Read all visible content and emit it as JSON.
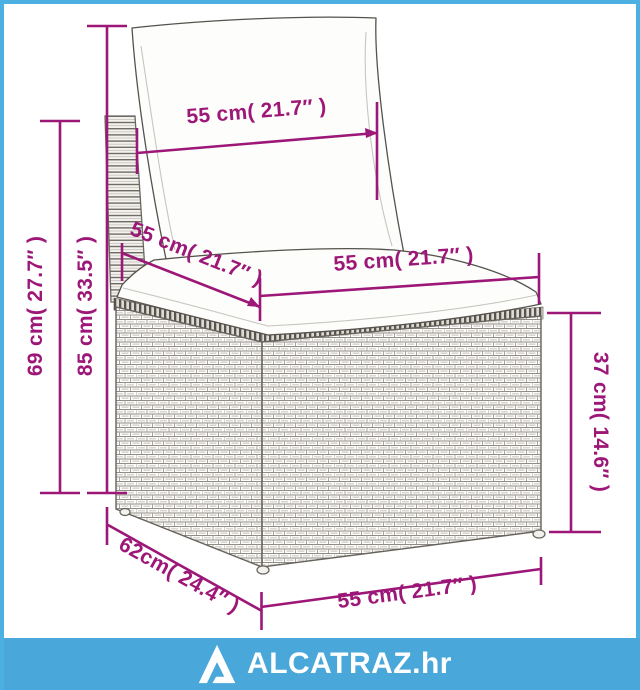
{
  "frame": {
    "border_color": "#4db0e2",
    "background": "#ffffff"
  },
  "annotations": {
    "color": "#9c1777",
    "back_width": {
      "label": "55 cm( 21.7″ )"
    },
    "total_height": {
      "label": "69 cm( 27.7″ )"
    },
    "backrest_height": {
      "label": "85 cm( 33.5″ )"
    },
    "seat_depth": {
      "label": "55 cm( 21.7″ )"
    },
    "seat_width": {
      "label": "55 cm( 21.7″ )"
    },
    "seat_height": {
      "label": "37 cm( 14.6″ )"
    },
    "base_depth": {
      "label": "62cm( 24.4″ )"
    },
    "base_width": {
      "label": "55 cm( 21.7″ )"
    }
  },
  "footer": {
    "bar_color": "#49a7d9",
    "logo_icon": "alcatraz-triangle-logo",
    "brand_text": "ALCATRAZ.hr"
  }
}
